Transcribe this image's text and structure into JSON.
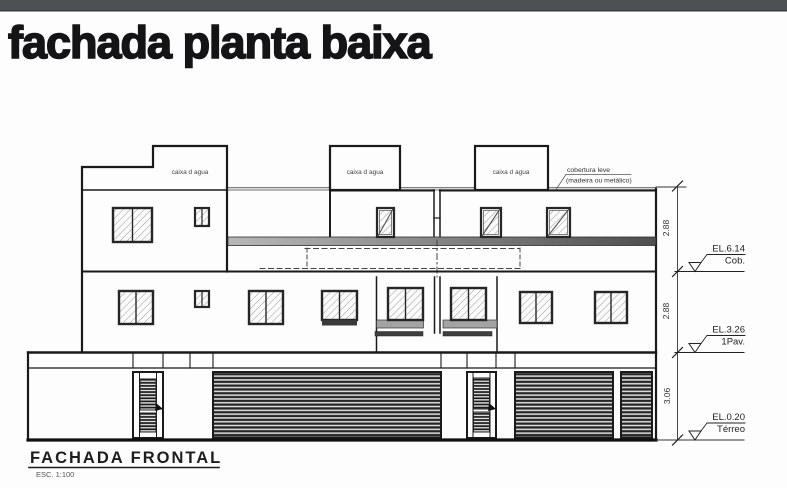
{
  "header": {
    "title": "fachada planta baixa"
  },
  "colors": {
    "topbar": "#4c5254",
    "line": "#1a1a1a",
    "slab_light": "#b8b8b8",
    "slab_dark": "#4e4e4e",
    "sill_gray": "#a3a3a3"
  },
  "drawing": {
    "water_tank_label": "caixa d agua",
    "roof_note": {
      "line1": "cobertura leve",
      "line2": "(madeira ou metálico)"
    },
    "dims": {
      "d1": "2.88",
      "d2": "2.88",
      "d3": "3.06"
    },
    "levels": {
      "cob": {
        "el": "EL.6.14",
        "name": "Cob."
      },
      "pav1": {
        "el": "EL.3.26",
        "name": "1Pav."
      },
      "terreo": {
        "el": "EL.0.20",
        "name": "Térreo"
      }
    },
    "caption": {
      "title": "FACHADA FRONTAL",
      "scale": "ESC. 1:100"
    }
  }
}
